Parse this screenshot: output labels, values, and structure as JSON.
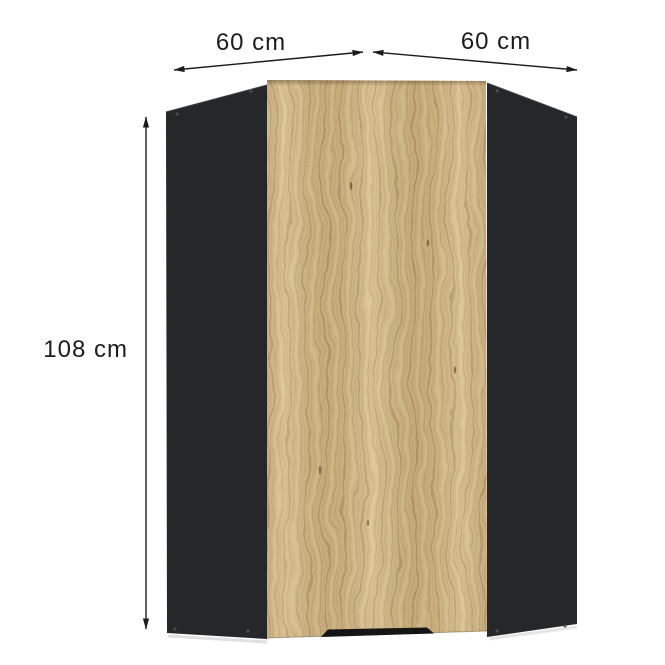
{
  "diagram": {
    "labels": {
      "width_left": "60 cm",
      "width_right": "60 cm",
      "height": "108 cm"
    },
    "colors": {
      "background": "#ffffff",
      "carcass": "#252729",
      "carcass_edge_highlight": "#3f4042",
      "door_base": "#cfb484",
      "door_grain_dark": "#a58a5a",
      "door_grain_light": "#e3d0a4",
      "handle": "#151515",
      "annotation": "#1c1c1c"
    }
  }
}
